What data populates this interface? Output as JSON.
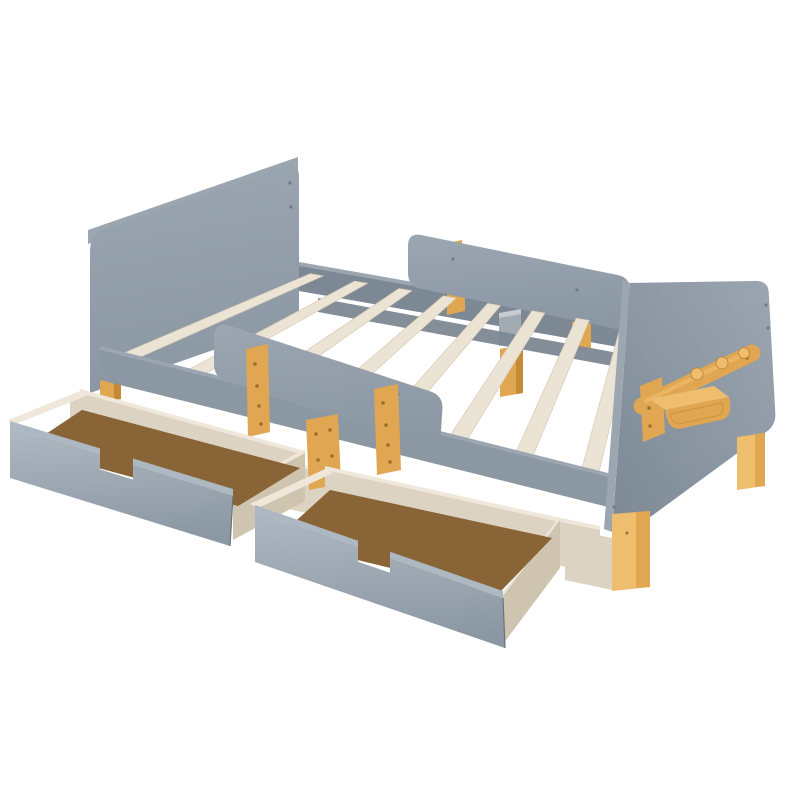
{
  "image": {
    "kind": "product-photo",
    "subject": "Toddler bed frame with two pull-out storage drawers, guardrails, wooden slats, hook rail and shelf on footboard",
    "background": "#ffffff"
  },
  "parts": {
    "headboard": "gray headboard panel",
    "footboard": "gray footboard panel with wooden hook rail and shelf",
    "far_guardrail": "far side guardrail",
    "near_guardrail": "near side guardrail",
    "back_rail": "back side rail",
    "front_rail": "front side rail",
    "center_rail": "center support rail",
    "center_post": "center wooden support post",
    "slats": "wooden support slats",
    "slat_count": 8,
    "drawer_left": "left storage drawer (pulled out)",
    "drawer_right": "right storage drawer (pulled out)",
    "drawer_count": 2,
    "hook_rail": "wooden hook rail",
    "peg_count": 3,
    "shelf": "wooden shelf",
    "legs": "natural wood legs",
    "storage_box": "under-bed storage box"
  },
  "colors": {
    "background": "#ffffff",
    "panel": "#8b97a3",
    "panel_light": "#9ba6b1",
    "panel_lighter": "#aeb8c2",
    "panel_dark": "#7c8894",
    "panel_edge": "#66727e",
    "slat": "#ebe3d3",
    "slat_edge": "#d7cab5",
    "whitewash": "#efe8da",
    "whitewash_shade": "#ddd3c2",
    "whitewash_dark": "#cfc4b0",
    "board": "#91602f",
    "wood": "#e0a652",
    "wood_light": "#eebe6e",
    "wood_dark": "#c48a38",
    "screw_gray": "#6f7c88",
    "screw_wood": "#9a6f2c",
    "metal": "#a3abb2",
    "metal_light": "#c6ccd1"
  }
}
